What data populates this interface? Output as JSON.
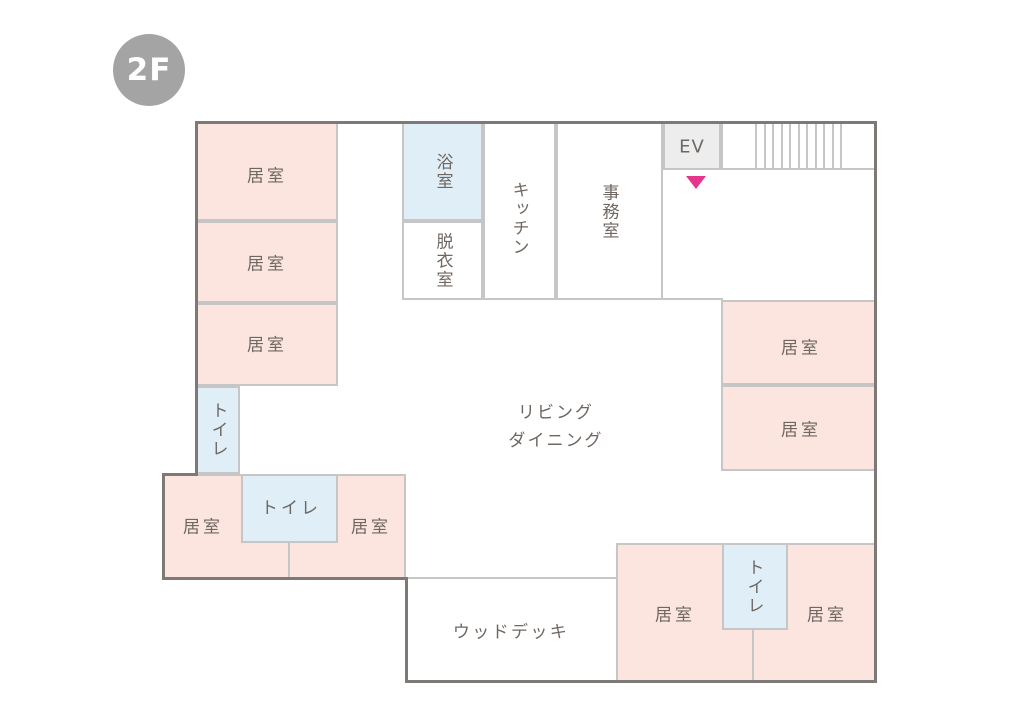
{
  "floor_badge": {
    "label": "2F"
  },
  "colors": {
    "room_pink": "#fbe5de",
    "room_blue": "#dfeef7",
    "elevator_gray": "#ededed",
    "wall_light": "#c6c6c6",
    "wall_dark": "#7c7977",
    "label_text": "#6f6761",
    "badge_bg": "#a4a4a4",
    "badge_text": "#ffffff",
    "marker_pink": "#e6358c"
  },
  "rooms": {
    "left_room_1": {
      "label": "居室"
    },
    "left_room_2": {
      "label": "居室"
    },
    "left_room_3": {
      "label": "居室"
    },
    "bathroom": {
      "label": "浴室"
    },
    "dressing_room": {
      "label": "脱衣室"
    },
    "kitchen": {
      "label": "キッチン"
    },
    "office": {
      "label": "事務室"
    },
    "elevator": {
      "label": "EV"
    },
    "living_dining": {
      "line1": "リビング",
      "line2": "ダイニング"
    },
    "right_room_1": {
      "label": "居室"
    },
    "right_room_2": {
      "label": "居室"
    },
    "west_toilet": {
      "label": "トイレ"
    },
    "sw_room_left": {
      "label": "居室"
    },
    "sw_toilet": {
      "label": "トイレ"
    },
    "sw_room_right": {
      "label": "居室"
    },
    "wood_deck": {
      "label": "ウッドデッキ"
    },
    "se_room_left": {
      "label": "居室"
    },
    "se_toilet": {
      "label": "トイレ"
    },
    "se_room_right": {
      "label": "居室"
    }
  },
  "marker": {
    "shape": "down-triangle",
    "color": "#e6358c"
  }
}
